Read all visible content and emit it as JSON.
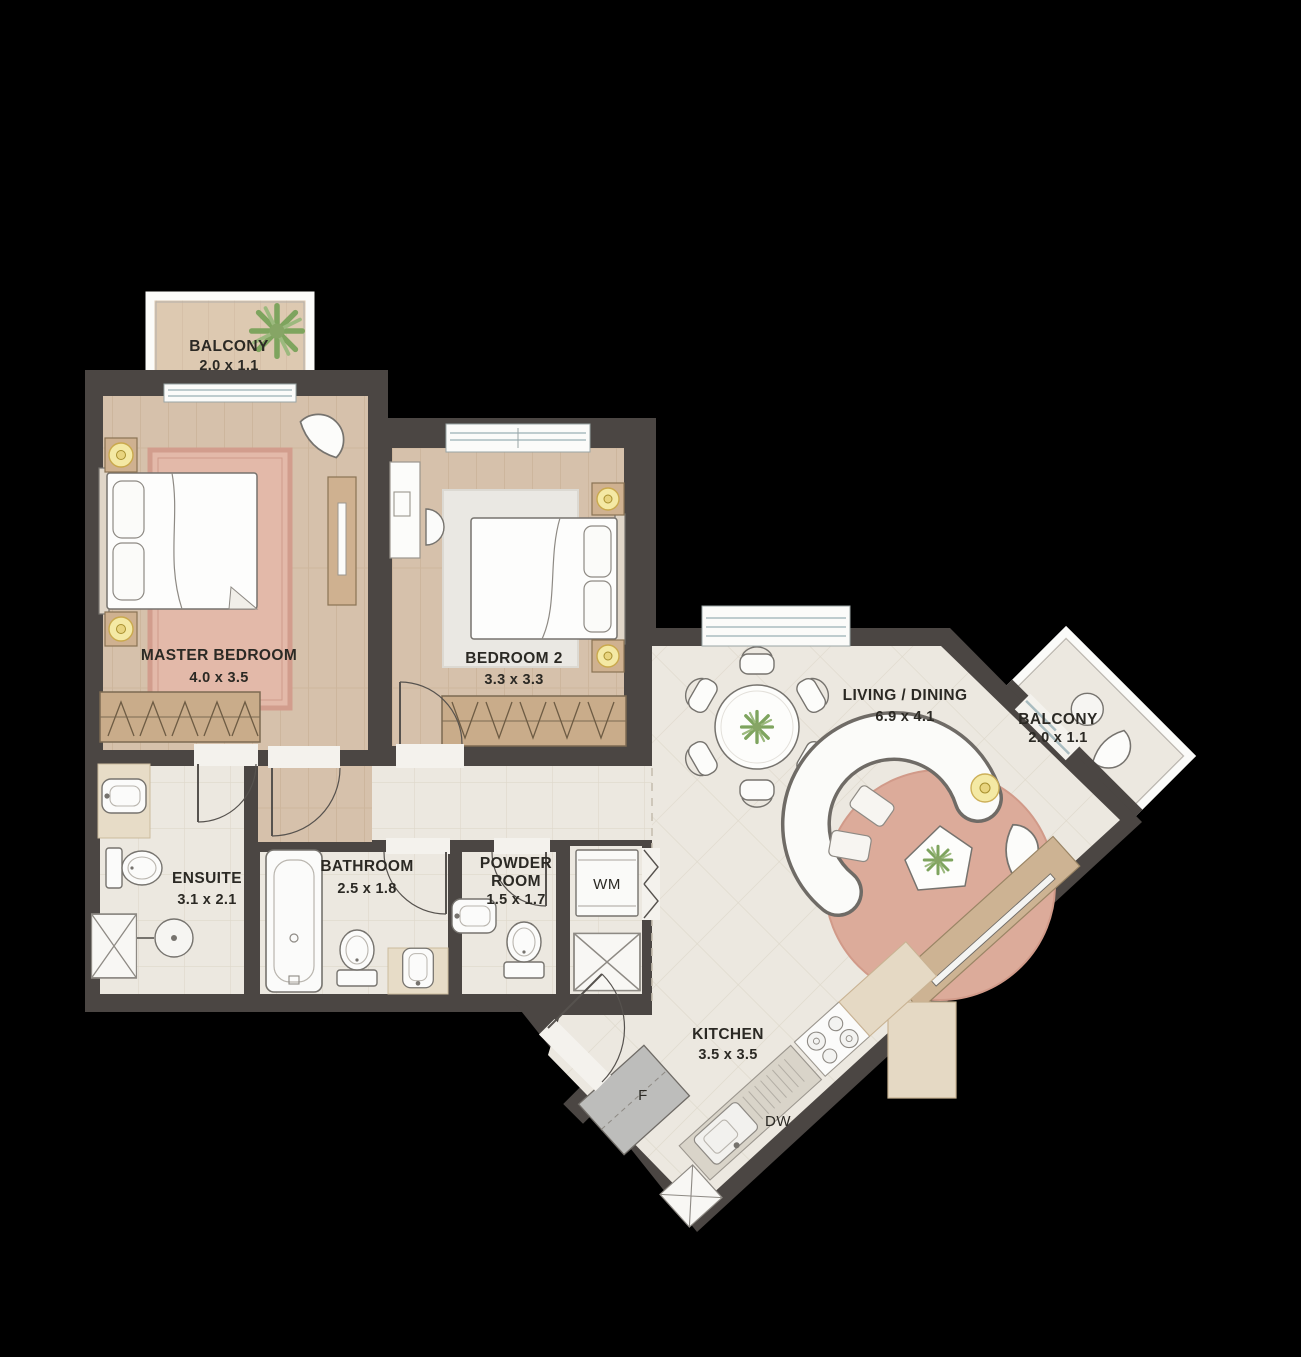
{
  "plan": {
    "type": "apartment-floor-plan",
    "labels": {
      "balcony_top": {
        "name": "BALCONY",
        "dims": "2.0 x 1.1"
      },
      "master": {
        "name": "MASTER BEDROOM",
        "dims": "4.0 x 3.5"
      },
      "bedroom2": {
        "name": "BEDROOM 2",
        "dims": "3.3 x 3.3"
      },
      "living": {
        "name": "LIVING / DINING",
        "dims": "6.9 x 4.1"
      },
      "balcony_right": {
        "name": "BALCONY",
        "dims": "2.0 x 1.1"
      },
      "ensuite": {
        "name": "ENSUITE",
        "dims": "3.1 x 2.1"
      },
      "bathroom": {
        "name": "BATHROOM",
        "dims": "2.5 x 1.8"
      },
      "powder": {
        "name_line1": "POWDER",
        "name_line2": "ROOM",
        "dims": "1.5 x 1.7"
      },
      "kitchen": {
        "name": "KITCHEN",
        "dims": "3.5 x 3.5"
      },
      "washing_machine": "WM",
      "fridge": "F",
      "dishwasher": "DW"
    },
    "colors": {
      "background": "#000000",
      "wall": "#4b4643",
      "wood_floor": "#d6c1ab",
      "tile_floor": "#ece8e0",
      "rug_pink": "#dcab9a",
      "wardrobe_wood": "#c9ac8a",
      "lamp_yellow": "#f4e9a4",
      "plant_green": "#7ea45e",
      "label_text": "#2b2924"
    }
  }
}
